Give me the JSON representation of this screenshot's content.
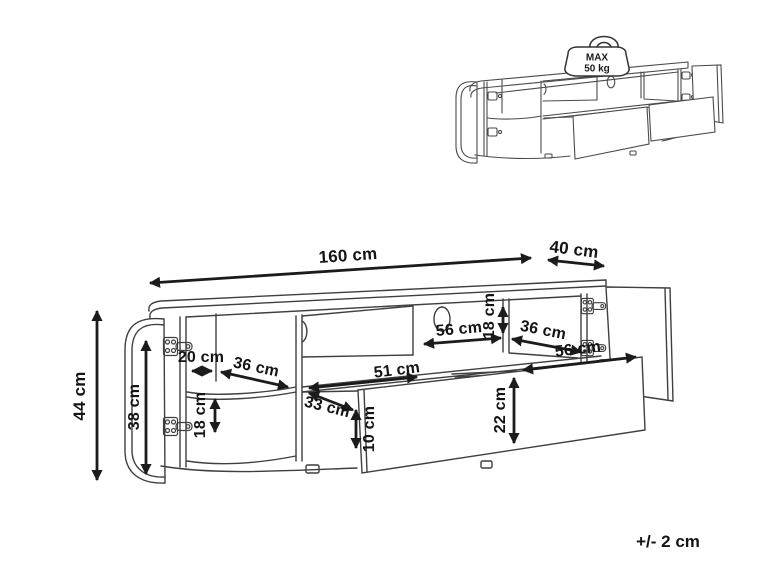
{
  "drawing": {
    "title_hint": "TV stand assembly dimension diagram",
    "tolerance_note": "+/- 2 cm",
    "max_load_badge": {
      "line1": "MAX",
      "line2": "50 kg"
    },
    "dimensions": {
      "total_width": "160 cm",
      "depth": "40 cm",
      "total_height": "44 cm",
      "door_height": "38 cm",
      "left_compartment_width": "20 cm",
      "left_shelf_depth": "36 cm",
      "left_lower_compartment_height": "18 cm",
      "center_compartment_width": "33 cm",
      "drawer_inner_width": "51 cm",
      "drawer_clearance_height": "10 cm",
      "open_shelf_width": "56 cm",
      "open_shelf_height": "18 cm",
      "right_shelf_depth": "36 cm",
      "drawer_front_width": "56 cm",
      "drawer_front_height": "22 cm"
    },
    "colors": {
      "line": "#3f3f3f",
      "arrow": "#1b1b1b",
      "text": "#141414",
      "background": "#ffffff"
    }
  }
}
